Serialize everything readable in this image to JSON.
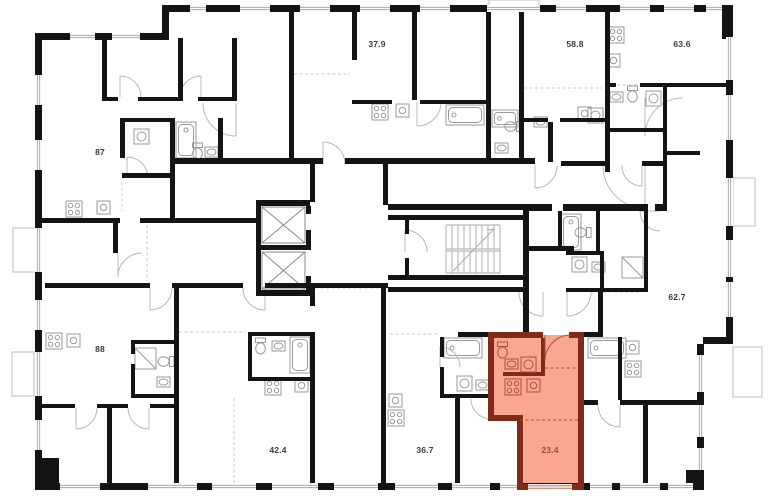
{
  "units": [
    {
      "area": "87",
      "highlighted": false
    },
    {
      "area": "37.9",
      "highlighted": false
    },
    {
      "area": "58.8",
      "highlighted": false
    },
    {
      "area": "63.6",
      "highlighted": false
    },
    {
      "area": "62.7",
      "highlighted": false
    },
    {
      "area": "88",
      "highlighted": false
    },
    {
      "area": "42.4",
      "highlighted": false
    },
    {
      "area": "36.7",
      "highlighted": false
    },
    {
      "area": "23.4",
      "highlighted": true
    }
  ],
  "colors": {
    "background": "#FFFFFF",
    "wall": "#141414",
    "label": "#3A3A3A",
    "fixture": "#9A9A9A",
    "door": "#B8B8B8",
    "dashed": "#C8C8C8",
    "balcony": "#C9C9C9",
    "highlight-fill": "#F9A78E",
    "highlight-wall": "#7E2B1A",
    "highlight-accent": "#A8523F",
    "highlight-label": "#A4442F"
  }
}
